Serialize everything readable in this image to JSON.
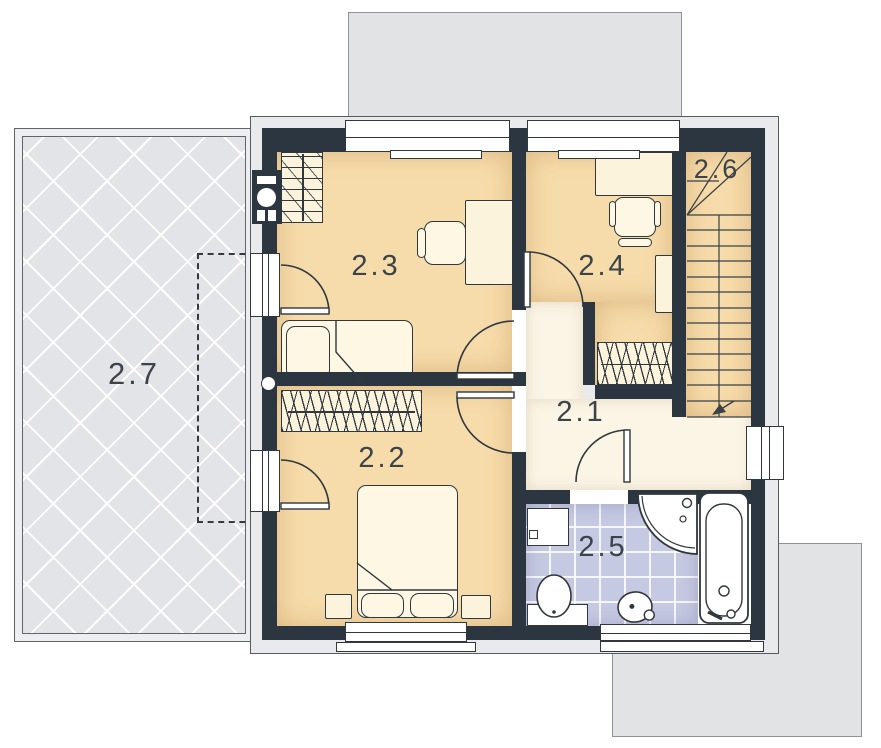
{
  "title": "first-floor-plan",
  "labels": {
    "r21": "2.1",
    "r22": "2.2",
    "r23": "2.3",
    "r24": "2.4",
    "r25": "2.5",
    "r26": "2.6",
    "r27": "2.7"
  },
  "colors": {
    "wall": "#2c3640",
    "line": "#30373d",
    "floorWarm": "#f7dcab",
    "floorLight": "#fbf5e6",
    "tile": "#c6c9e2",
    "terrace": "#e3e4e7",
    "roof": "#e2e3e5",
    "outerBand": "#e9eaec",
    "furniture": "#fbf3dc",
    "labelColor": "#3c4449"
  }
}
